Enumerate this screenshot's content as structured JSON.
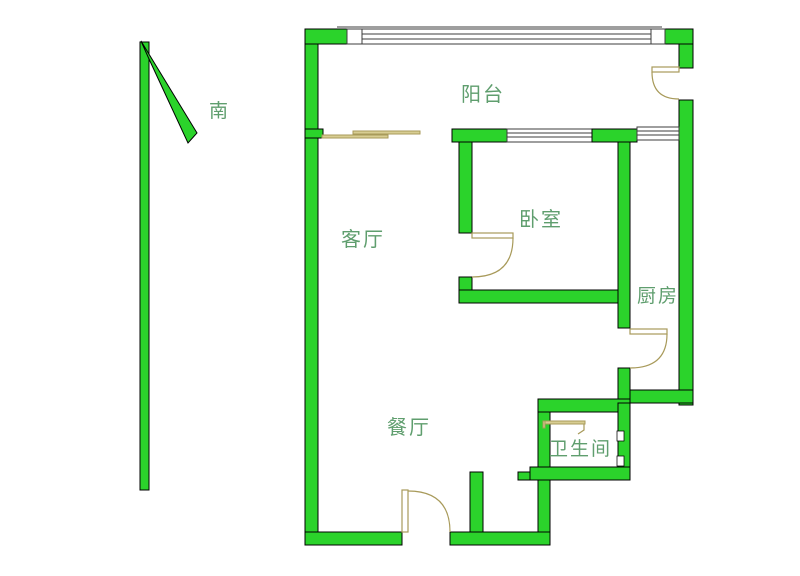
{
  "compass": {
    "label": "南"
  },
  "rooms": {
    "balcony": "阳台",
    "living_room": "客厅",
    "bedroom": "卧室",
    "kitchen": "厨房",
    "dining_room": "餐厅",
    "bathroom": "卫生间"
  },
  "colors": {
    "background": "#ffffff",
    "wall_fill": "#2bd32b",
    "wall_outline": "#000000",
    "door_stroke": "#a89a5a",
    "slide_fill": "#d8cd92",
    "window_stroke": "#3c3c3c",
    "label_text": "#5f9e6e"
  }
}
